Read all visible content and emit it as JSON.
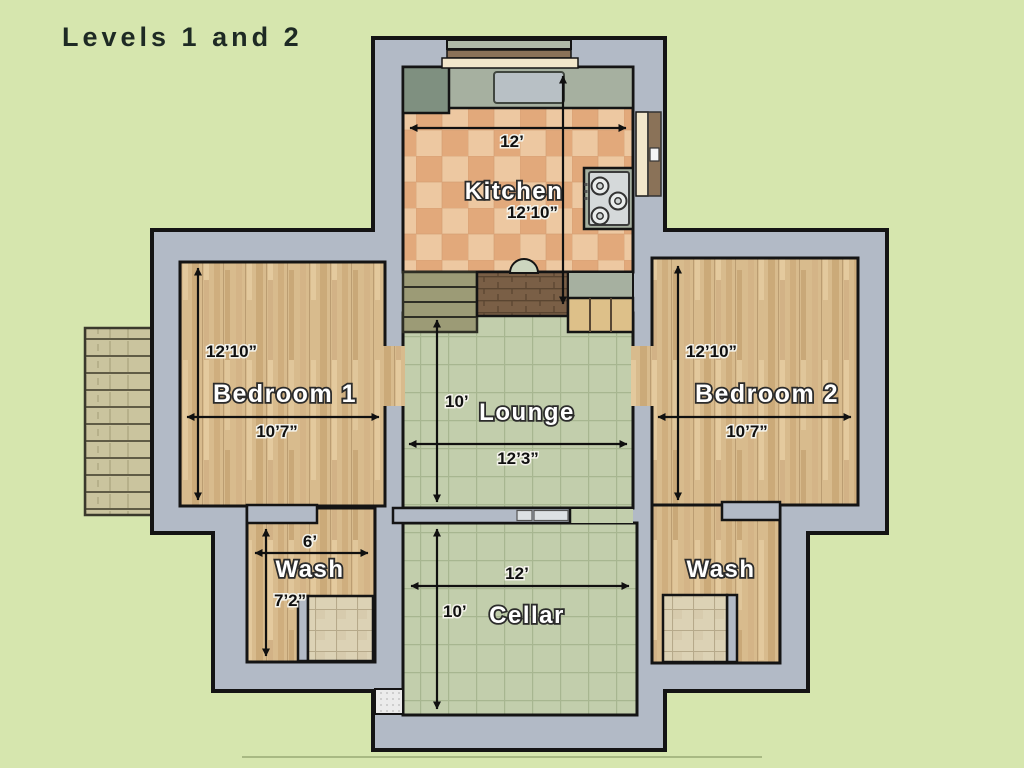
{
  "title": "Levels 1 and 2",
  "rooms": {
    "kitchen": {
      "name": "Kitchen",
      "width": "12’",
      "height": "12’10”"
    },
    "bedroom1": {
      "name": "Bedroom 1",
      "width": "10’7”",
      "height": "12’10”"
    },
    "bedroom2": {
      "name": "Bedroom 2",
      "width": "10’7”",
      "height": "12’10”"
    },
    "lounge": {
      "name": "Lounge",
      "width": "12’3”",
      "height": "10’"
    },
    "wash_left": {
      "name": "Wash",
      "width": "6’",
      "height": "7’2”"
    },
    "wash_right": {
      "name": "Wash"
    },
    "cellar": {
      "name": "Cellar",
      "width": "12’",
      "height": "10’"
    }
  },
  "colors": {
    "background": "#d6e6ae",
    "wall": "#b2bac6",
    "outline": "#141414",
    "wood_floor": "#d8bb8d",
    "kitchen_tile": "#e8b285",
    "green_tile": "#c2ceac",
    "counter": "#a6b0a0",
    "brick": "#7a5f46",
    "stair": "#9c9b76"
  }
}
